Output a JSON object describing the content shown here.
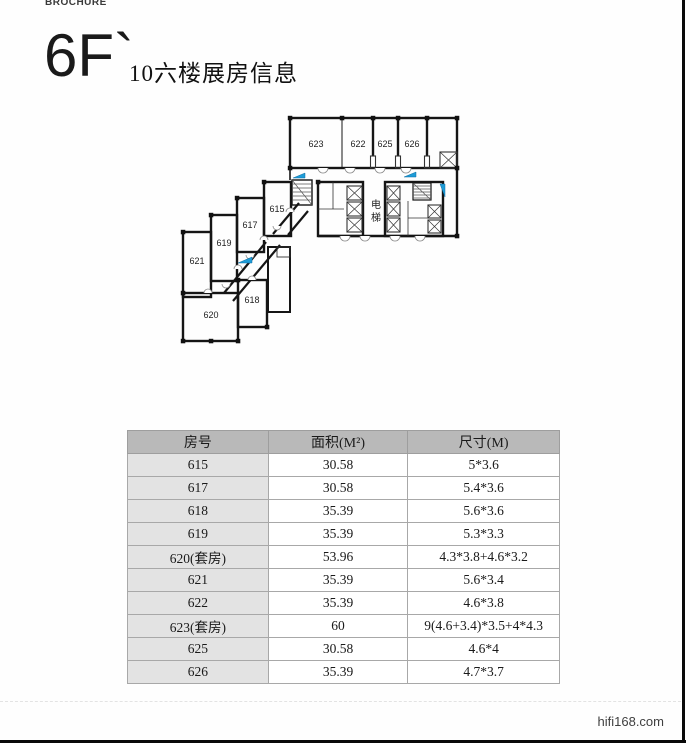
{
  "page": {
    "brand": "BROCHURE",
    "floor_label": "6F`",
    "title": "10六楼展房信息",
    "watermark": "hifi168.com"
  },
  "floor_plan": {
    "elevator_label": "电梯",
    "accent_color": "#1e9cd7",
    "room_labels": {
      "r615": "615",
      "r617": "617",
      "r618": "618",
      "r619": "619",
      "r620": "620",
      "r621": "621",
      "r622": "622",
      "r623": "623",
      "r625": "625",
      "r626": "626"
    }
  },
  "table": {
    "headers": [
      "房号",
      "面积(M²)",
      "尺寸(M)"
    ],
    "rows": [
      [
        "615",
        "30.58",
        "5*3.6"
      ],
      [
        "617",
        "30.58",
        "5.4*3.6"
      ],
      [
        "618",
        "35.39",
        "5.6*3.6"
      ],
      [
        "619",
        "35.39",
        "5.3*3.3"
      ],
      [
        "620(套房)",
        "53.96",
        "4.3*3.8+4.6*3.2"
      ],
      [
        "621",
        "35.39",
        "5.6*3.4"
      ],
      [
        "622",
        "35.39",
        "4.6*3.8"
      ],
      [
        "623(套房)",
        "60",
        "9(4.6+3.4)*3.5+4*4.3"
      ],
      [
        "625",
        "30.58",
        "4.6*4"
      ],
      [
        "626",
        "35.39",
        "4.7*3.7"
      ]
    ]
  }
}
